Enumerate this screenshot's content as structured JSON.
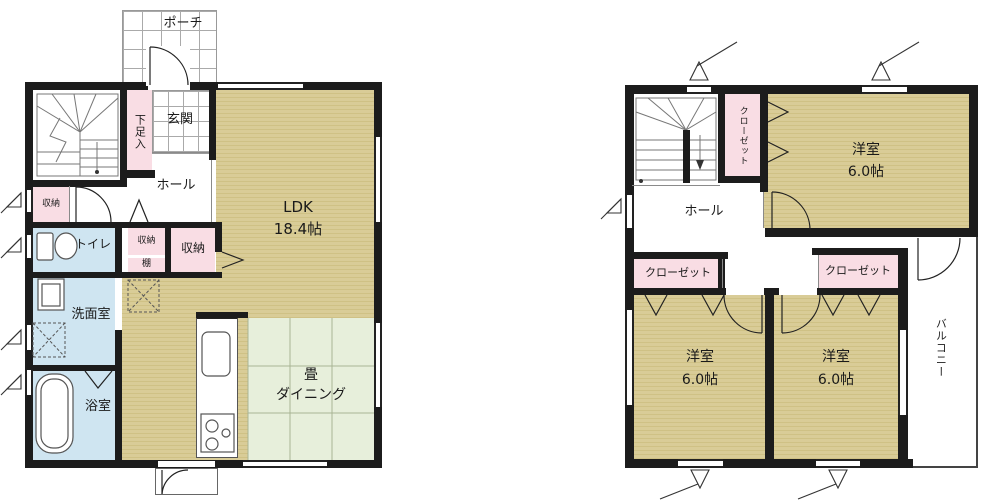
{
  "floor1": {
    "porch": "ポーチ",
    "entrance": "玄関",
    "shoe_cupboard": "下足入",
    "hall": "ホール",
    "storage_a": "収納",
    "toilet": "トイレ",
    "storage_b": "収納",
    "shelf": "棚",
    "storage_c": "収納",
    "washroom": "洗面室",
    "bathroom": "浴室",
    "ldk_name": "LDK",
    "ldk_size": "18.4帖",
    "tatami_line1": "畳",
    "tatami_line2": "ダイニング"
  },
  "floor2": {
    "closet_upper": "クローゼット",
    "hall": "ホール",
    "closet_left": "クローゼット",
    "closet_right": "クローゼット",
    "bedroom_top_name": "洋室",
    "bedroom_top_size": "6.0帖",
    "bedroom_left_name": "洋室",
    "bedroom_left_size": "6.0帖",
    "bedroom_right_name": "洋室",
    "bedroom_right_size": "6.0帖",
    "balcony": "バルコニー"
  },
  "colors": {
    "wall": "#1c1c1c",
    "wood_floor": "#d9cc97",
    "tatami_green": "#e7efdb",
    "wet_room_blue": "#cfe5f1",
    "closet_pink": "#f9dde4"
  }
}
